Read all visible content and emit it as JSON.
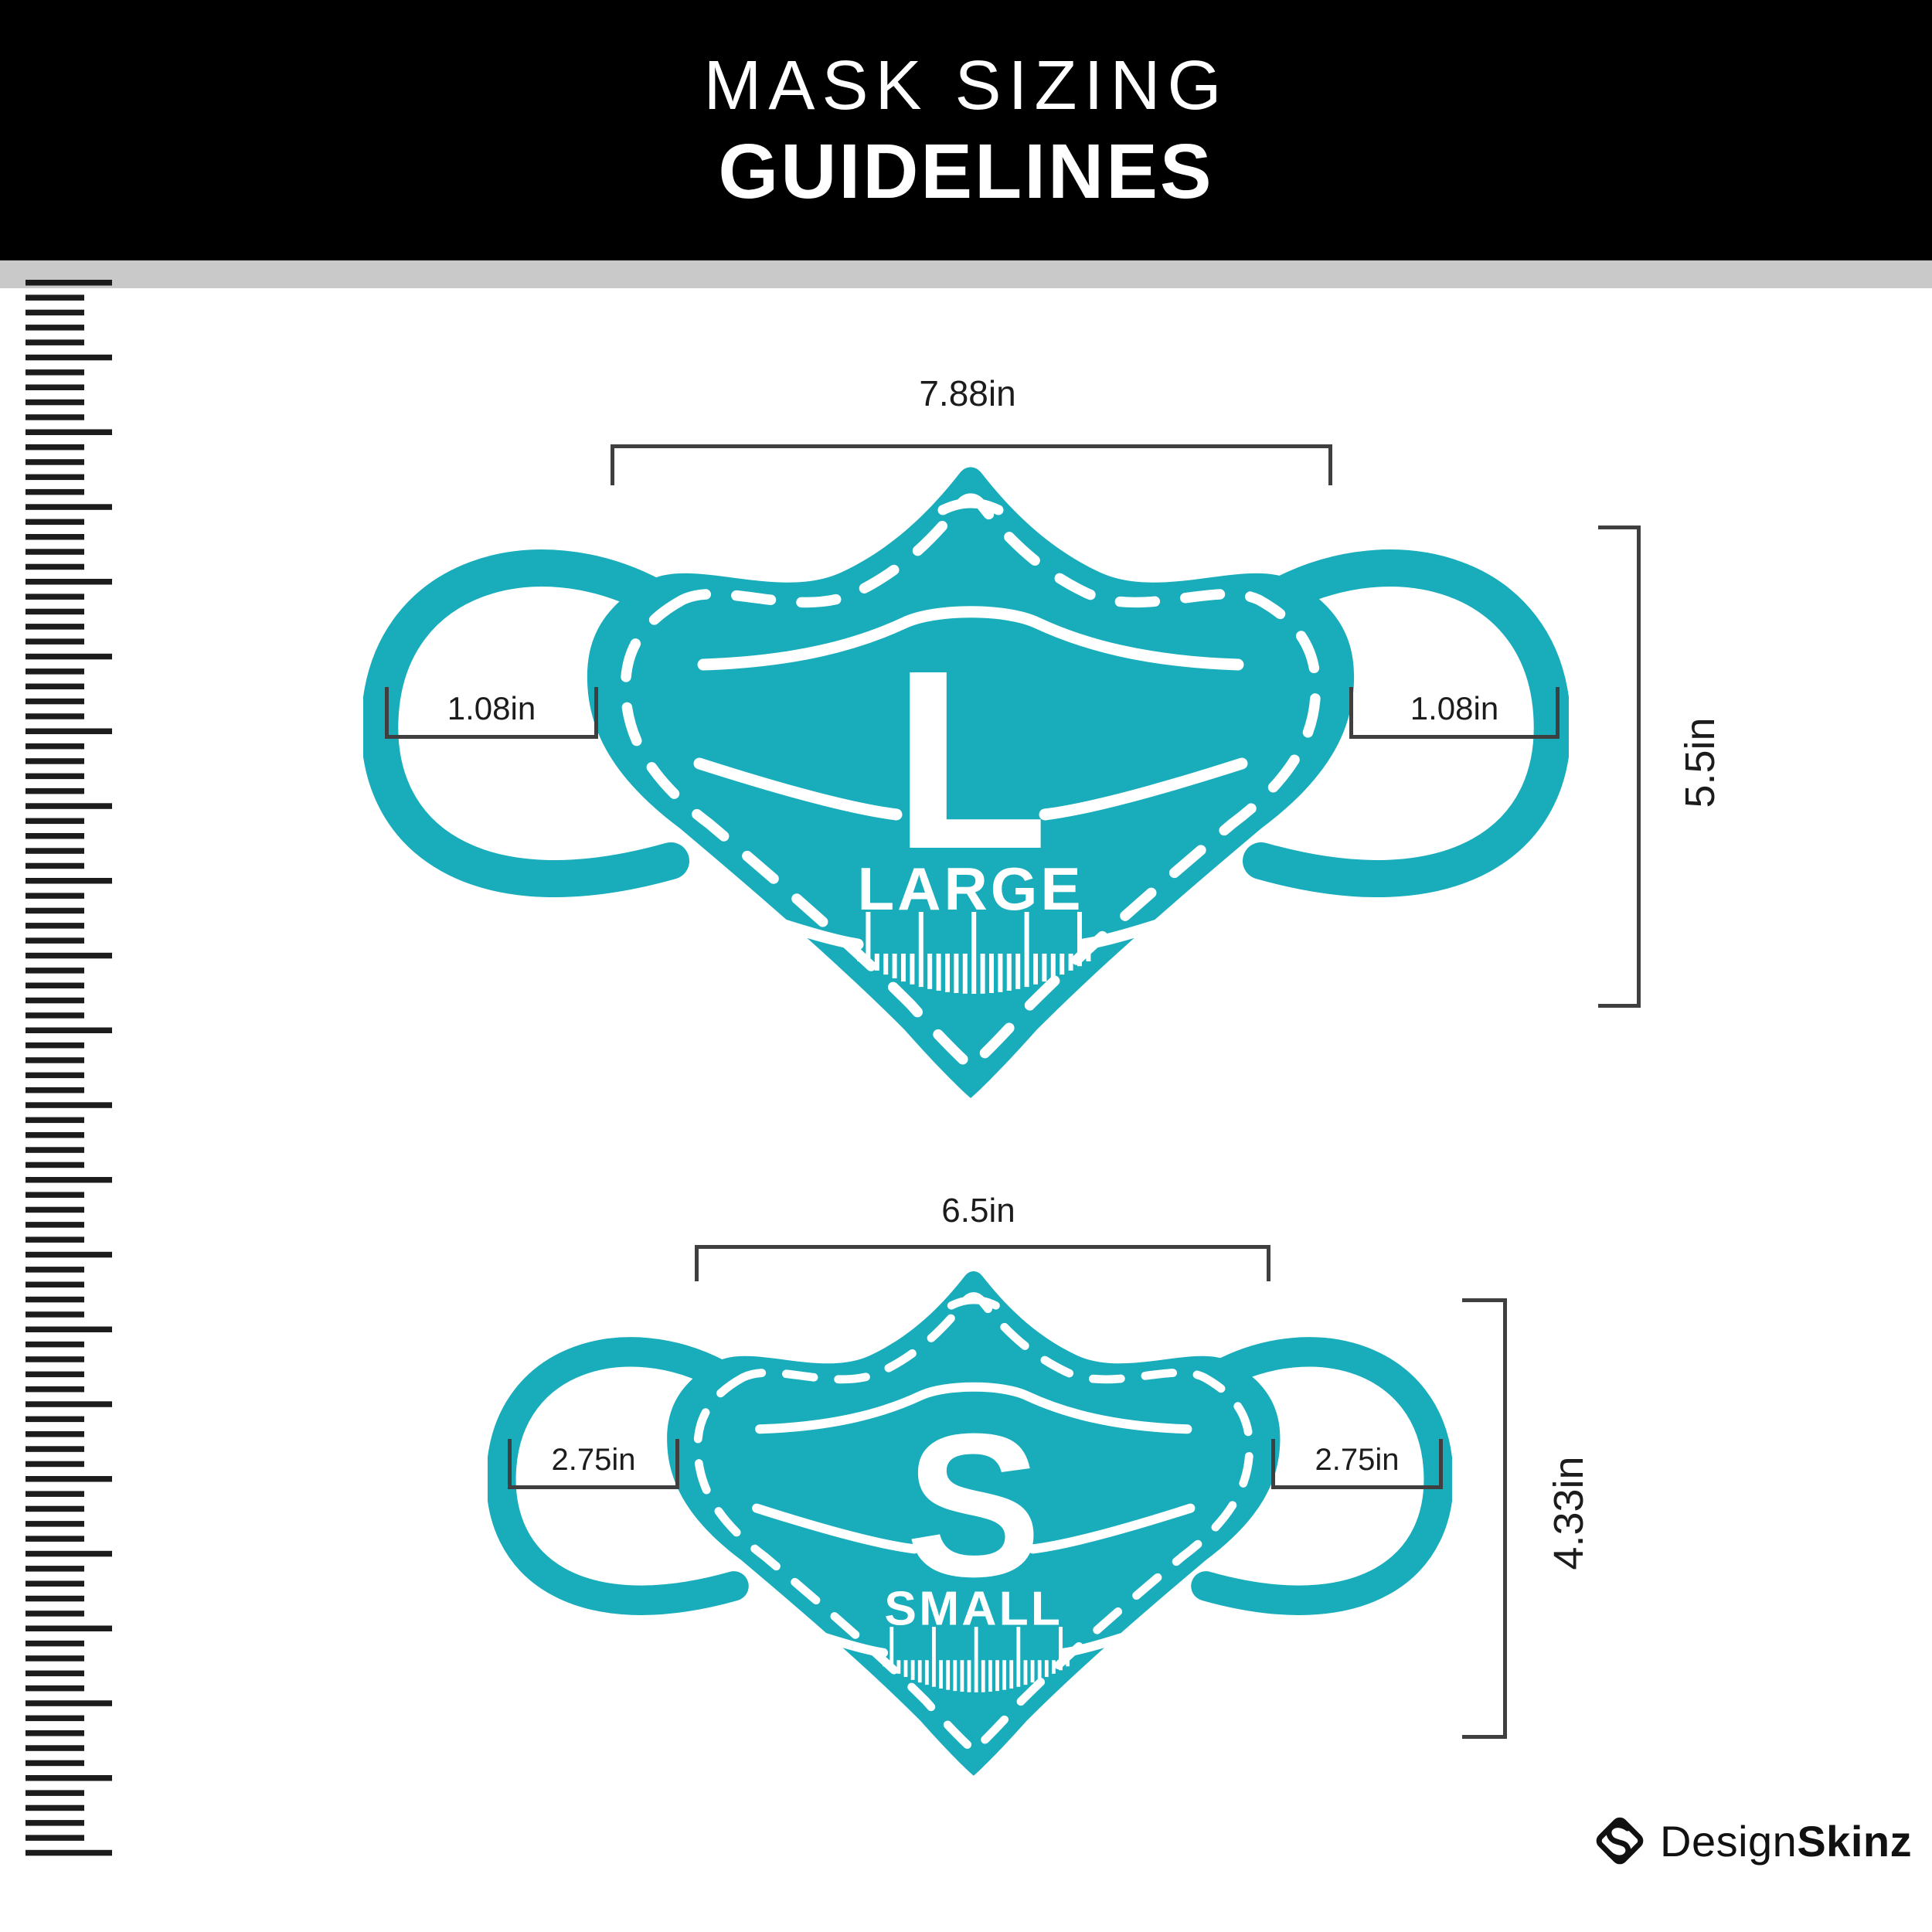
{
  "header": {
    "line1": "MASK SIZING",
    "line2": "GUIDELINES"
  },
  "masks": {
    "large": {
      "letter": "L",
      "name": "LARGE",
      "width_label": "7.88in",
      "height_label": "5.5in",
      "ear_left_label": "1.08in",
      "ear_right_label": "1.08in"
    },
    "small": {
      "letter": "S",
      "name": "SMALL",
      "width_label": "6.5in",
      "height_label": "4.33in",
      "ear_left_label": "2.75in",
      "ear_right_label": "2.75in"
    }
  },
  "footer": {
    "brand_regular": "Design",
    "brand_bold": "Skinz"
  },
  "colors": {
    "teal": "#19adbc",
    "ink": "#1c1c1c",
    "bracket": "#3f3f3f",
    "divider": "#c9c9c9",
    "header_bg": "#000000"
  },
  "ruler": {
    "tick_count": 106,
    "major_every": 5,
    "step": 19.35,
    "minor_len": 76,
    "major_len": 112,
    "thickness": 7.5
  },
  "mask_ruler_glyph": {
    "bars": 27,
    "major_every": 6,
    "major_offset": 1
  }
}
